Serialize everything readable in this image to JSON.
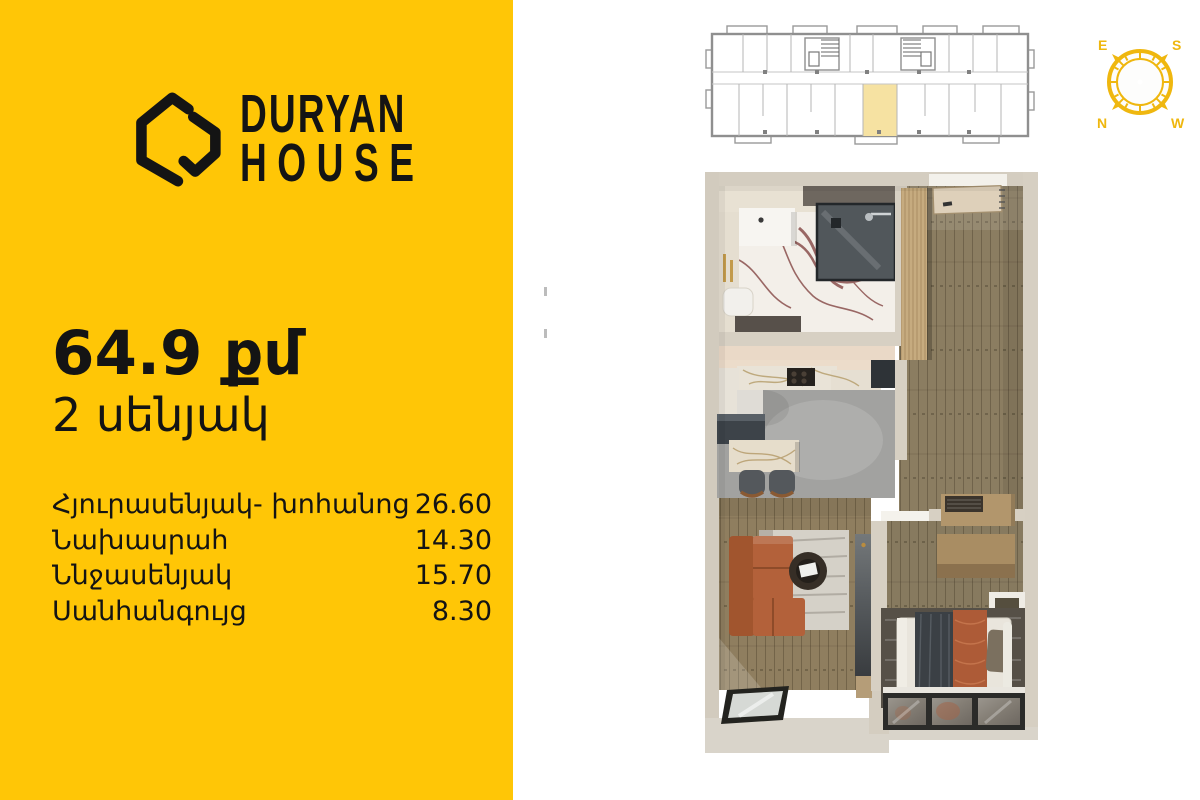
{
  "brand": {
    "line1": "DURYAN",
    "line2": "HOUSE"
  },
  "unit": {
    "area_label": "64.9 քմ",
    "rooms_label": "2 սենյակ"
  },
  "rooms": [
    {
      "label": "Հյուրասենյակ- խոհանոց",
      "area": "26.60"
    },
    {
      "label": "Նախասրահ",
      "area": "14.30"
    },
    {
      "label": "Ննջասենյակ",
      "area": "15.70"
    },
    {
      "label": "Սանհանգույց",
      "area": "8.30"
    }
  ],
  "compass": {
    "letters": {
      "e": "E",
      "s": "S",
      "n": "N",
      "w": "W"
    }
  },
  "colors": {
    "panel_yellow": "#FFC606",
    "text_black": "#141414",
    "unit_highlight": "#F6E2A2",
    "compass_gold": "#EFB70F",
    "needle_red": "#C03A28",
    "needle_gray": "#6E6E6E",
    "wall_beige": "#D4CDC0",
    "wood_floor": "#8B7D61",
    "sofa_rust": "#B3613A"
  }
}
